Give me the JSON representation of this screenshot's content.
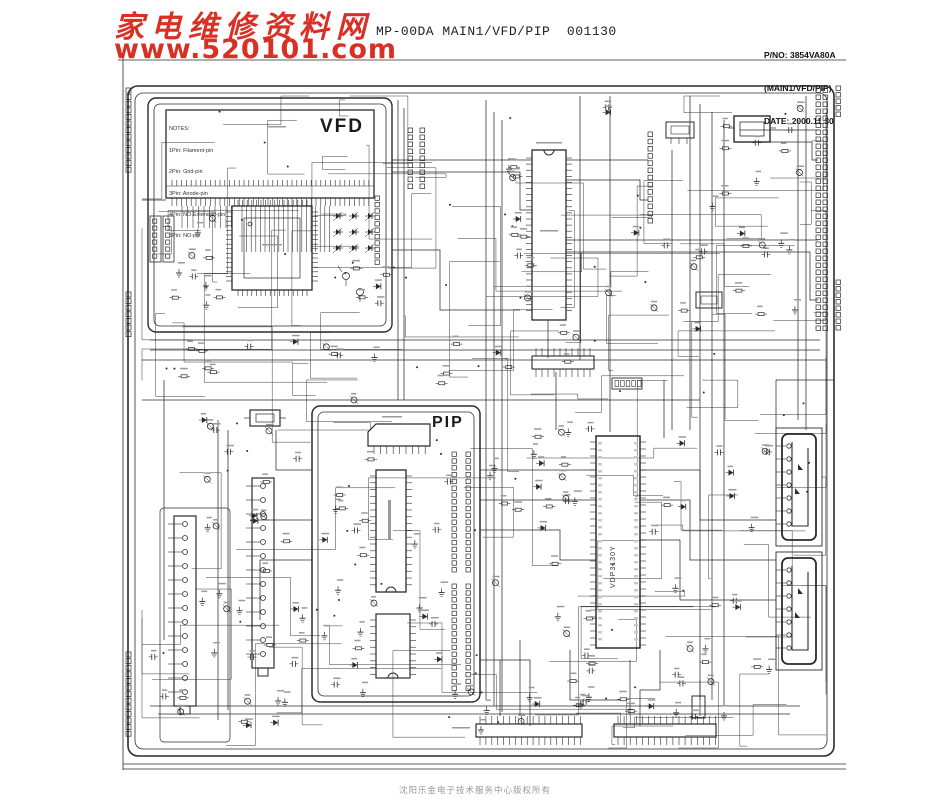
{
  "header": {
    "site_name": "家电维修资料网",
    "site_url": "www.520101.com",
    "title": "MP-00DA MAIN1/VFD/PIP  001130",
    "part_no": "P/NO: 3854VA80A",
    "board_name": "(MAIN1/VFD/PIP)",
    "date": "DATE: 2000.11.30"
  },
  "blocks": {
    "vfd": {
      "label": "VFD",
      "notes": [
        "NOTES:",
        "1Pin: Filament-pin",
        "2Pin: Grid-pin",
        "3Pin: Anode-pin",
        "4Pin: NO.Extended-pin",
        "5Pin: NO-pin"
      ]
    },
    "pip": {
      "label": "PIP"
    },
    "main_video_ic": {
      "label": "VDP3130Y"
    }
  },
  "footer": {
    "copyright": "沈阳乐金电子技术服务中心版权所有"
  },
  "colors": {
    "accent_red": "#d93025",
    "line": "#2b2b2b",
    "paper": "#ffffff"
  }
}
